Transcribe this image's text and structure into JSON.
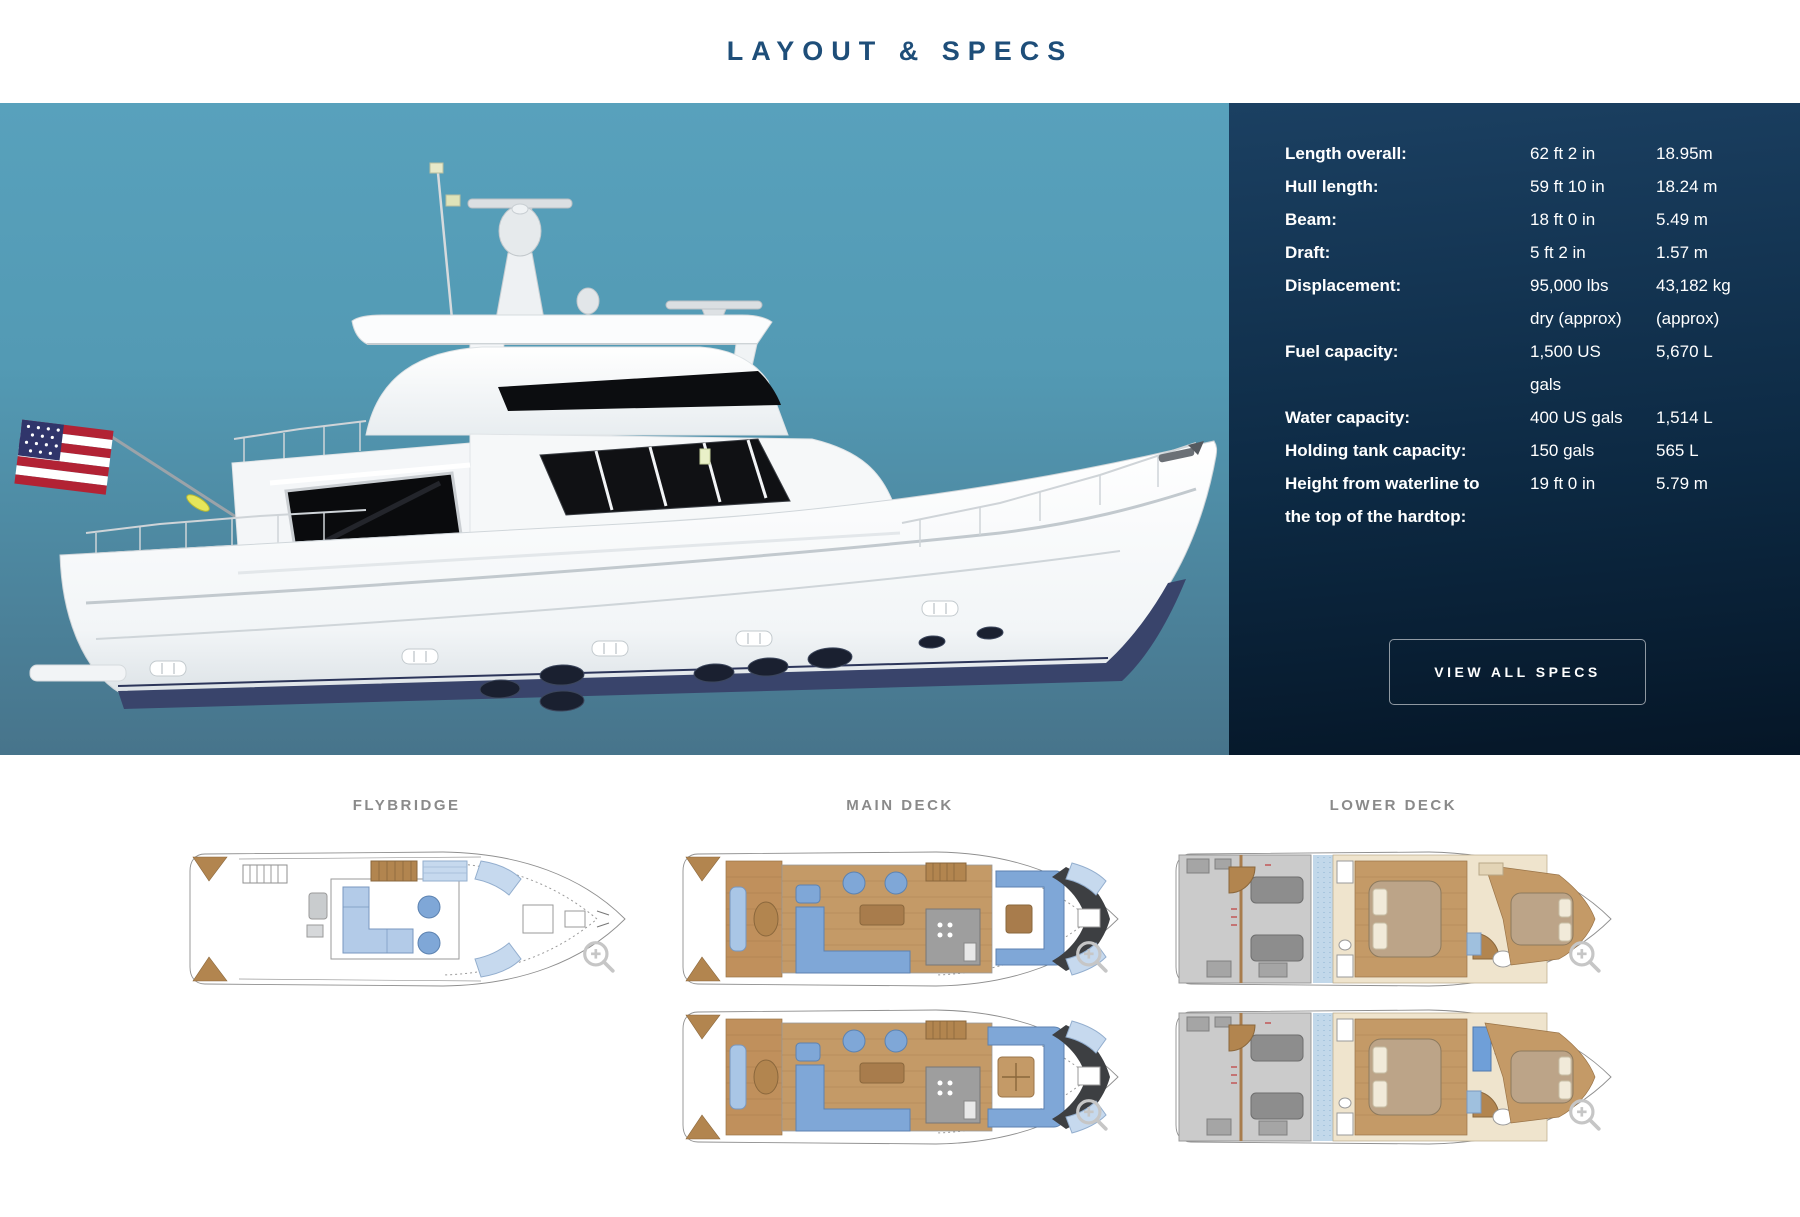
{
  "header": {
    "title": "LAYOUT & SPECS"
  },
  "specs": {
    "rows": [
      {
        "label": "Length overall:",
        "imperial": "62 ft 2 in",
        "metric": "18.95m"
      },
      {
        "label": "Hull length:",
        "imperial": "59 ft 10 in",
        "metric": "18.24 m"
      },
      {
        "label": "Beam:",
        "imperial": "18 ft 0 in",
        "metric": "5.49 m"
      },
      {
        "label": "Draft:",
        "imperial": "5 ft 2 in",
        "metric": "1.57 m"
      },
      {
        "label": "Displacement:",
        "imperial": "95,000 lbs\ndry (approx)",
        "metric": "43,182 kg\n(approx)"
      },
      {
        "label": "Fuel capacity:",
        "imperial": "1,500 US\ngals",
        "metric": "5,670 L"
      },
      {
        "label": "Water capacity:",
        "imperial": "400 US gals",
        "metric": "1,514 L"
      },
      {
        "label": "Holding tank capacity:",
        "imperial": "150 gals",
        "metric": "565 L"
      },
      {
        "label": "Height from waterline to\nthe top of the hardtop:",
        "imperial": "19 ft 0 in",
        "metric": "5.79 m"
      }
    ],
    "view_all_label": "VIEW ALL SPECS"
  },
  "decks": {
    "flybridge_label": "FLYBRIDGE",
    "main_label": "MAIN DECK",
    "lower_label": "LOWER DECK"
  },
  "icons": {
    "magnifier": "zoom-plus-magnifier"
  },
  "colors": {
    "title_blue": "#1e4e79",
    "hero_top": "#58a1bc",
    "hero_bottom": "#47748b",
    "panel_top": "#1b4062",
    "panel_bottom": "#051627",
    "deck_label_gray": "#8a8a8a",
    "hull_stripe_navy": "#39446b"
  }
}
